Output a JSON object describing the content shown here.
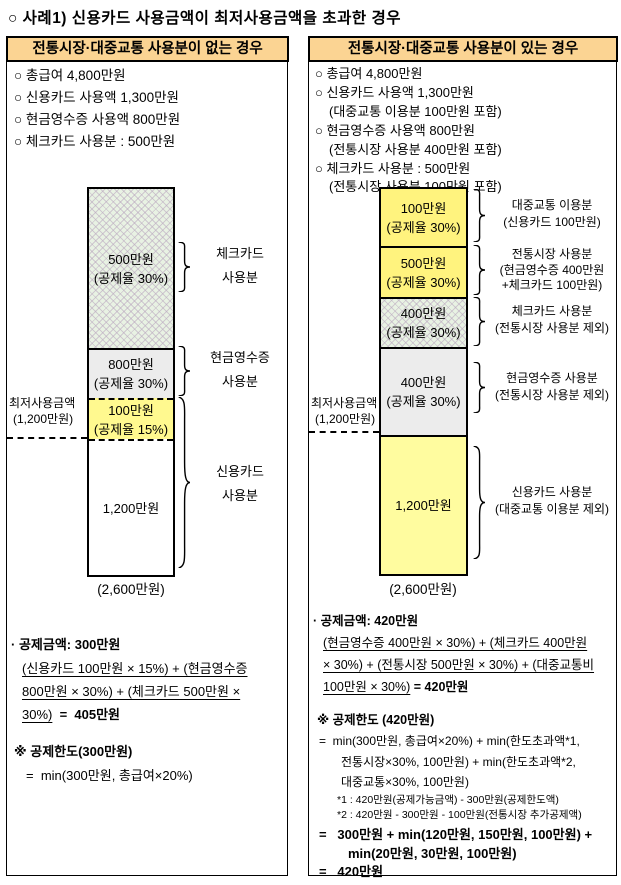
{
  "colors": {
    "header-bg": "#FBD493",
    "yellow-bright": "#FFF37E",
    "yellow-left": "#FFF98F",
    "yellow-pale": "#FFFC9F",
    "seg-gray": "#ECECEC",
    "hatch-bg": "#E8F2E3"
  },
  "title": "○ 사례1) 신용카드 사용금액이 최저사용금액을 초과한 경우",
  "left_panel": {
    "header": "전통시장·대중교통 사용분이 없는 경우",
    "bullets": [
      "○ 총급여 4,800만원",
      "○ 신용카드 사용액 1,300만원",
      "○ 현금영수증 사용액 800만원",
      "○ 체크카드 사용분 : 500만원"
    ],
    "min_usage": {
      "line1": "최저사용금액",
      "line2": "(1,200만원)"
    },
    "total": "(2,600만원)",
    "segments": [
      {
        "amount": "500만원",
        "rate": "(공제율 30%)"
      },
      {
        "amount": "800만원",
        "rate": "(공제율 30%)"
      },
      {
        "amount": "100만원",
        "rate": "(공제율 15%)"
      },
      {
        "amount": "1,200만원"
      }
    ],
    "braces": [
      {
        "label1": "체크카드",
        "label2": "사용분"
      },
      {
        "label1": "현금영수증",
        "label2": "사용분"
      },
      {
        "label1": "신용카드",
        "label2": "사용분"
      }
    ],
    "deduction": {
      "title": "· 공제금액: 300만원",
      "f1": "(신용카드 100만원 × 15%) + (현금영수증",
      "f2": "800만원 × 30%) + (체크카드 500만원 ×",
      "f3": "30%)",
      "result": "  =  405만원"
    },
    "limit": {
      "title": "※  공제한도(300만원)",
      "line1": "=  min(300만원, 총급여×20%)"
    }
  },
  "right_panel": {
    "header": "전통시장·대중교통 사용분이 있는 경우",
    "bullets": [
      "○ 총급여 4,800만원",
      "○ 신용카드 사용액 1,300만원",
      "(대중교통 이용분 100만원 포함)",
      "○ 현금영수증 사용액 800만원",
      "(전통시장 사용분 400만원 포함)",
      "○ 체크카드 사용분 : 500만원",
      "(전통시장 사용분 100만원 포함)"
    ],
    "min_usage": {
      "line1": "최저사용금액",
      "line2": "(1,200만원)"
    },
    "total": "(2,600만원)",
    "segments": [
      {
        "amount": "100만원",
        "rate": "(공제율 30%)"
      },
      {
        "amount": "500만원",
        "rate": "(공제율 30%)"
      },
      {
        "amount": "400만원",
        "rate": "(공제율 30%)"
      },
      {
        "amount": "400만원",
        "rate": "(공제율 30%)"
      },
      {
        "amount": "1,200만원"
      }
    ],
    "braces": [
      {
        "label1": "대중교통 이용분",
        "label2": "(신용카드 100만원)"
      },
      {
        "label1": "전통시장 사용분",
        "label2": "(현금영수증 400만원",
        "label3": "+체크카드 100만원)"
      },
      {
        "label1": "체크카드 사용분",
        "label2": "(전통시장 사용분 제외)"
      },
      {
        "label1": "현금영수증 사용분",
        "label2": "(전통시장 사용분 제외)"
      },
      {
        "label1": "신용카드 사용분",
        "label2": "(대중교통 이용분 제외)"
      }
    ],
    "deduction": {
      "title": "· 공제금액: 420만원",
      "f1": "(현금영수증 400만원 × 30%) +  (체크카드 400만원",
      "f2": "× 30%) + (전통시장 500만원 × 30%) + (대중교통비",
      "f3": "100만원 × 30%)",
      "result": " = 420만원"
    },
    "limit": {
      "title": "※  공제한도 (420만원)",
      "line1": "=  min(300만원, 총급여×20%) + min(한도초과액*1,",
      "line2": "전통시장×30%, 100만원) + min(한도초과액*2,",
      "line3": "대중교통×30%, 100만원)",
      "fn1": "*1 : 420만원(공제가능금액) - 300만원(공제한도액)",
      "fn2": "*2 : 420만원 - 300만원 - 100만원(전통시장 추가공제액)",
      "r1": "=   300만원 + min(120만원, 150만원, 100만원) +",
      "r2": "min(20만원, 30만원, 100만원)",
      "r3": "=   420만원"
    }
  },
  "chart_data": [
    {
      "type": "bar",
      "title": "전통시장·대중교통 사용분이 없는 경우",
      "stacked": true,
      "total_manwon": 2600,
      "min_usage_manwon": 1200,
      "segments_top_to_bottom": [
        {
          "label": "체크카드 사용분",
          "value_manwon": 500,
          "rate": "공제율 30%"
        },
        {
          "label": "현금영수증 사용분",
          "value_manwon": 800,
          "rate": "공제율 30%"
        },
        {
          "label": "신용카드 사용분",
          "value_manwon": 100,
          "rate": "공제율 15%"
        },
        {
          "label": "신용카드 사용분",
          "value_manwon": 1200
        }
      ]
    },
    {
      "type": "bar",
      "title": "전통시장·대중교통 사용분이 있는 경우",
      "stacked": true,
      "total_manwon": 2600,
      "min_usage_manwon": 1200,
      "segments_top_to_bottom": [
        {
          "label": "대중교통 이용분 (신용카드 100만원)",
          "value_manwon": 100,
          "rate": "공제율 30%"
        },
        {
          "label": "전통시장 사용분 (현금영수증 400만원+체크카드 100만원)",
          "value_manwon": 500,
          "rate": "공제율 30%"
        },
        {
          "label": "체크카드 사용분 (전통시장 사용분 제외)",
          "value_manwon": 400,
          "rate": "공제율 30%"
        },
        {
          "label": "현금영수증 사용분 (전통시장 사용분 제외)",
          "value_manwon": 400,
          "rate": "공제율 30%"
        },
        {
          "label": "신용카드 사용분 (대중교통 이용분 제외)",
          "value_manwon": 1200
        }
      ]
    }
  ]
}
